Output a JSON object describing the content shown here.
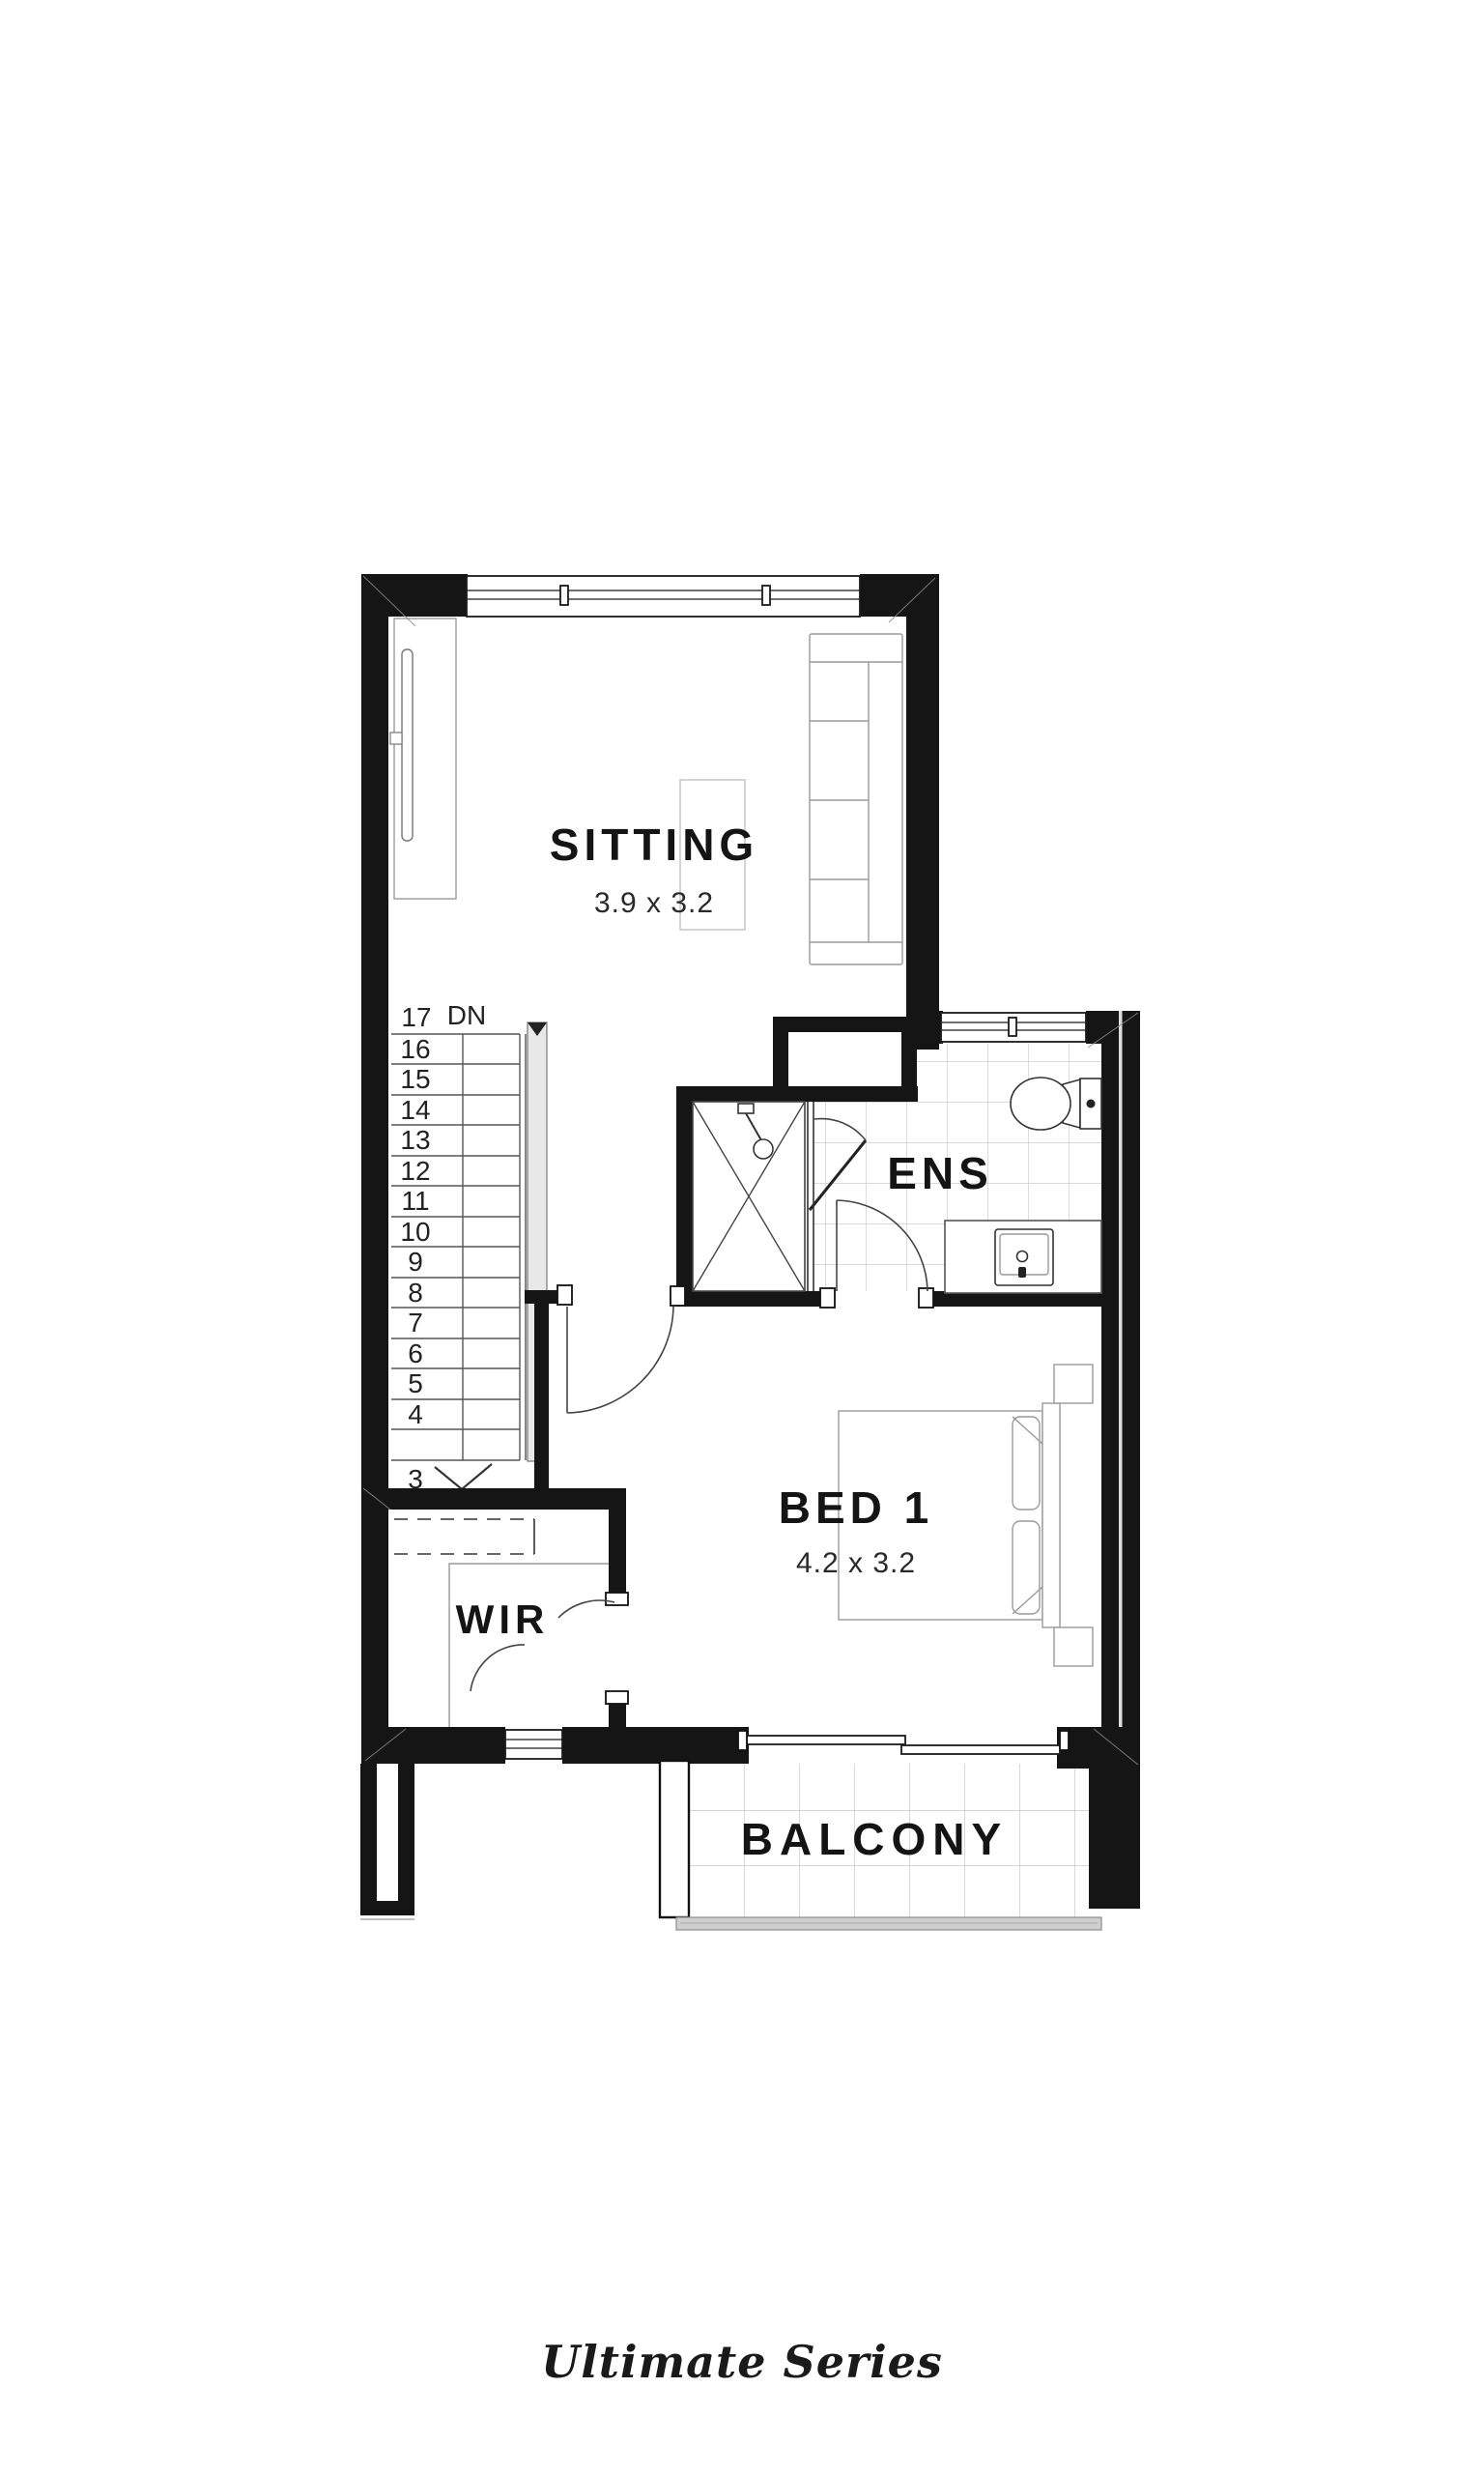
{
  "plan": {
    "rooms": {
      "sitting": {
        "name": "SITTING",
        "dims": "3.9 x 3.2"
      },
      "ens": {
        "name": "ENS"
      },
      "bed1": {
        "name": "BED 1",
        "dims": "4.2 x 3.2"
      },
      "wir": {
        "name": "WIR"
      },
      "balcony": {
        "name": "BALCONY"
      }
    },
    "stairs": {
      "down_label": "DN",
      "numbers": [
        "17",
        "16",
        "15",
        "14",
        "13",
        "12",
        "11",
        "10",
        "9",
        "8",
        "7",
        "6",
        "5",
        "4",
        "3"
      ]
    },
    "footer": {
      "series_label": "Ultimate Series"
    },
    "colors": {
      "wall": "#151515",
      "tile_line": "#c4c4c4",
      "furniture_line": "#9a9a9a",
      "handrail_fill": "#e8e8e8",
      "fascia_fill": "#cfcfcf",
      "text": "#141414"
    }
  }
}
